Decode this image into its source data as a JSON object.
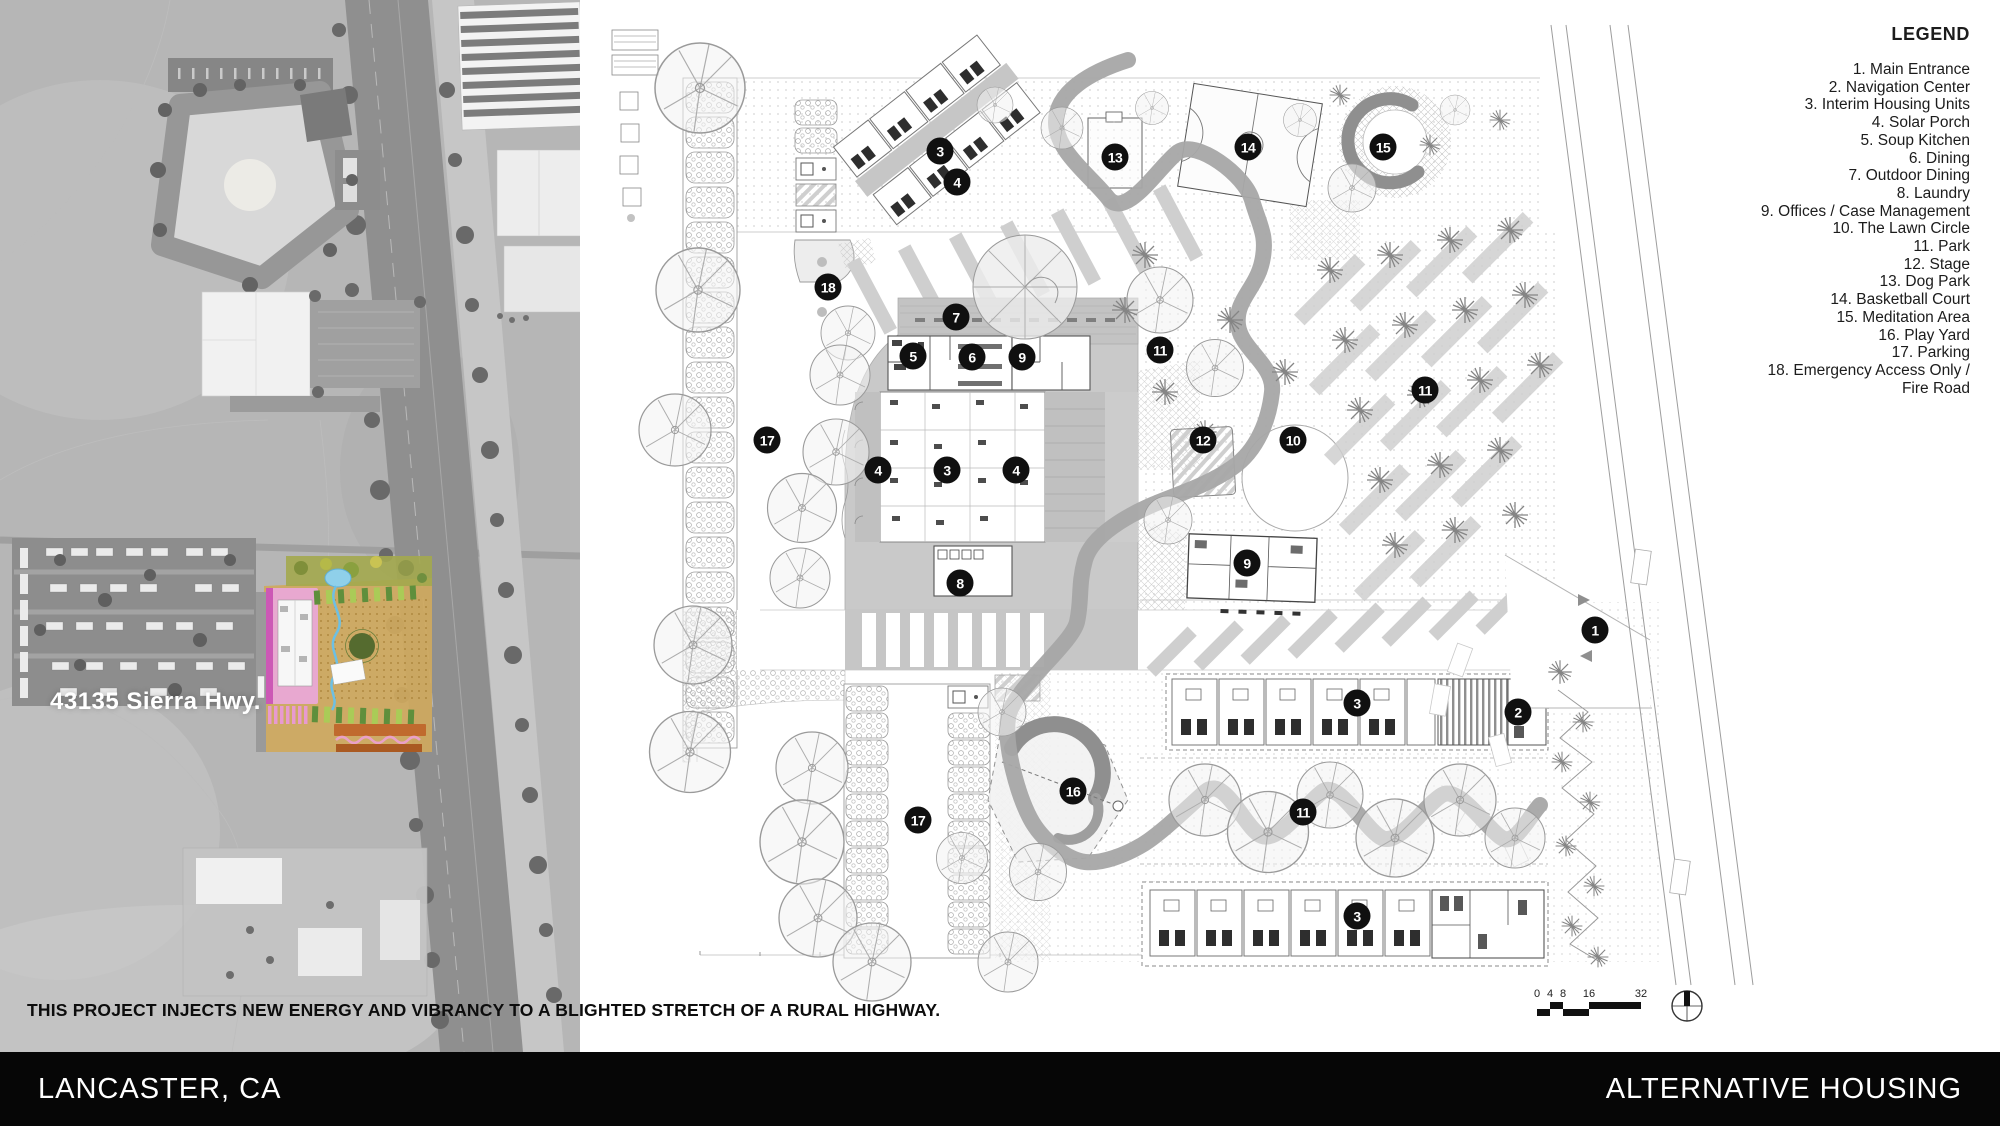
{
  "footer": {
    "location": "LANCASTER, CA",
    "project": "ALTERNATIVE HOUSING"
  },
  "statement": "THIS PROJECT INJECTS NEW ENERGY AND VIBRANCY TO A BLIGHTED STRETCH OF A RURAL HIGHWAY.",
  "satellite": {
    "address_label": "43135 Sierra Hwy."
  },
  "legend": {
    "title": "LEGEND",
    "items": [
      "1. Main Entrance",
      "2. Navigation Center",
      "3. Interim Housing Units",
      "4. Solar Porch",
      "5. Soup Kitchen",
      "6. Dining",
      "7. Outdoor Dining",
      "8. Laundry",
      "9. Offices / Case Management",
      "10. The Lawn Circle",
      "11. Park",
      "12. Stage",
      "13. Dog Park",
      "14. Basketball Court",
      "15. Meditation Area",
      "16. Play Yard",
      "17. Parking",
      "18. Emergency Access Only /\nFire Road"
    ]
  },
  "markers": [
    {
      "n": "1",
      "x": 1595,
      "y": 630
    },
    {
      "n": "2",
      "x": 1518,
      "y": 712
    },
    {
      "n": "3",
      "x": 940,
      "y": 151
    },
    {
      "n": "3",
      "x": 947,
      "y": 470
    },
    {
      "n": "3",
      "x": 1357,
      "y": 703
    },
    {
      "n": "3",
      "x": 1357,
      "y": 916
    },
    {
      "n": "4",
      "x": 957,
      "y": 182
    },
    {
      "n": "4",
      "x": 878,
      "y": 470
    },
    {
      "n": "4",
      "x": 1016,
      "y": 470
    },
    {
      "n": "5",
      "x": 913,
      "y": 356
    },
    {
      "n": "6",
      "x": 972,
      "y": 357
    },
    {
      "n": "7",
      "x": 956,
      "y": 317
    },
    {
      "n": "8",
      "x": 960,
      "y": 583
    },
    {
      "n": "9",
      "x": 1022,
      "y": 357
    },
    {
      "n": "9",
      "x": 1247,
      "y": 563
    },
    {
      "n": "10",
      "x": 1293,
      "y": 440
    },
    {
      "n": "11",
      "x": 1160,
      "y": 350
    },
    {
      "n": "11",
      "x": 1425,
      "y": 390
    },
    {
      "n": "11",
      "x": 1303,
      "y": 812
    },
    {
      "n": "12",
      "x": 1203,
      "y": 440
    },
    {
      "n": "13",
      "x": 1115,
      "y": 157
    },
    {
      "n": "14",
      "x": 1248,
      "y": 147
    },
    {
      "n": "15",
      "x": 1383,
      "y": 147
    },
    {
      "n": "16",
      "x": 1073,
      "y": 791
    },
    {
      "n": "17",
      "x": 767,
      "y": 440
    },
    {
      "n": "17",
      "x": 918,
      "y": 820
    },
    {
      "n": "18",
      "x": 828,
      "y": 287
    }
  ],
  "scale_bar": {
    "labels": [
      "0",
      "4",
      "8",
      "16",
      "32"
    ]
  }
}
